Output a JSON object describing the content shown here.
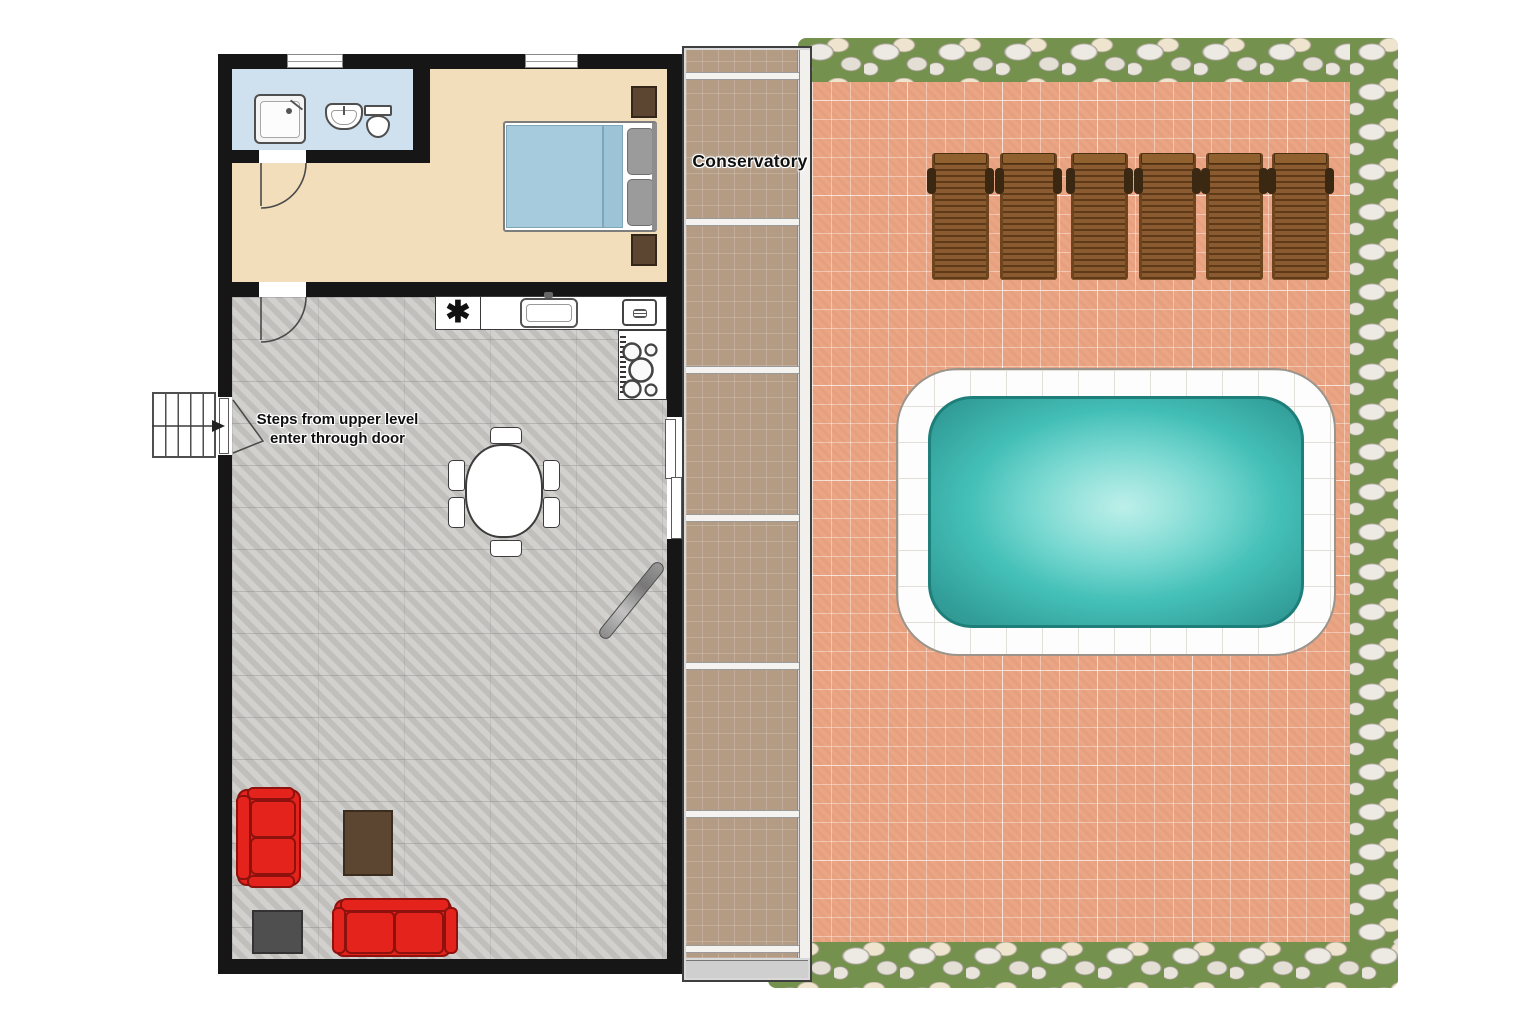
{
  "labels": {
    "conservatory": "Conservatory",
    "steps_note_line1": "Steps from upper level",
    "steps_note_line2": "enter through door",
    "stove_symbol": "✱"
  },
  "colors": {
    "wall": "#161616",
    "bathroom_floor": "#cfe0ef",
    "bedroom_floor": "#f3debb",
    "living_floor": "#cac9c6",
    "conservatory_floor": "#b39b84",
    "patio_tile": "#eaa684",
    "pool_water": "#43bfb7",
    "pool_deck": "#fdfdfd",
    "sofa": "#e3231c",
    "lounger_wood": "#8a5a30",
    "coffee_table": "#5c4531",
    "grass": "#75914e",
    "bed_duvet": "#a5cbdd"
  },
  "counts": {
    "sun_loungers": 6,
    "dining_chairs": 6,
    "sofas": 2
  }
}
